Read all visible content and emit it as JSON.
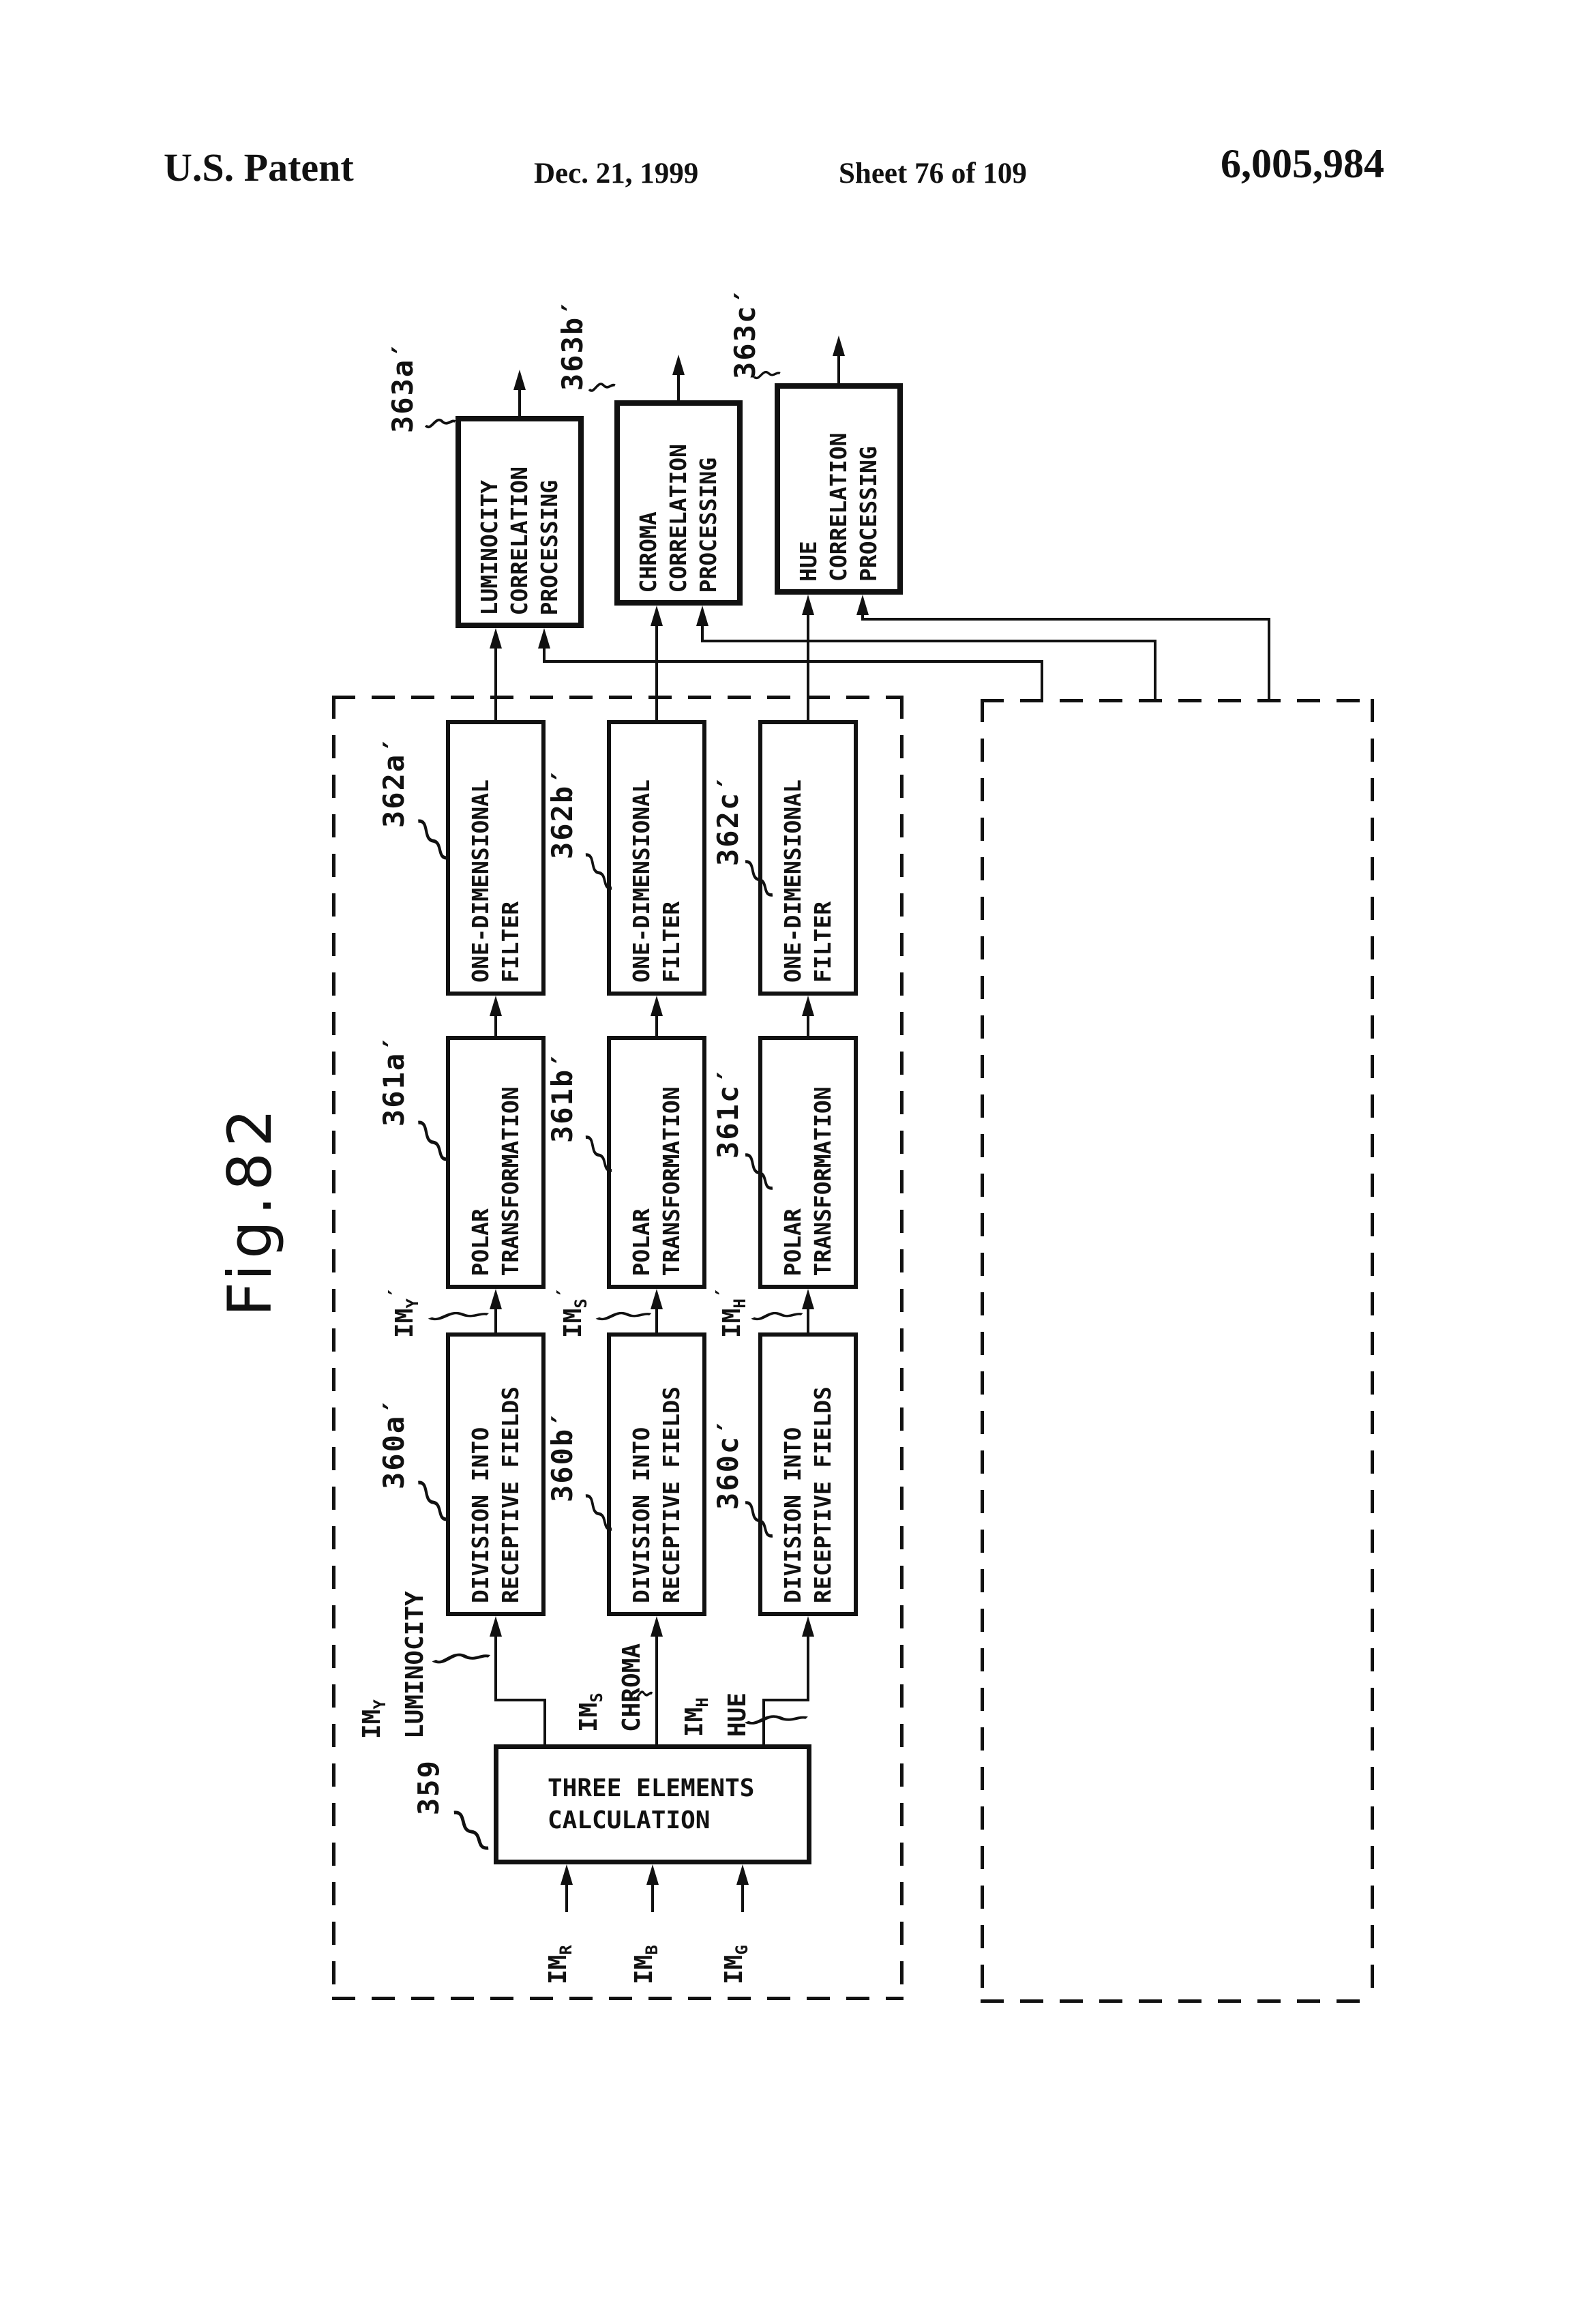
{
  "header": {
    "title": "U.S. Patent",
    "date": "Dec. 21, 1999",
    "sheet": "Sheet 76 of 109",
    "patent_number": "6,005,984"
  },
  "figure": {
    "label": "Fig.82"
  },
  "refs": {
    "r359": "359",
    "r360a": "360a′",
    "r360b": "360b′",
    "r360c": "360c′",
    "r361a": "361a′",
    "r361b": "361b′",
    "r361c": "361c′",
    "r362a": "362a′",
    "r362b": "362b′",
    "r362c": "362c′",
    "r363a": "363a′",
    "r363b": "363b′",
    "r363c": "363c′"
  },
  "blocks": {
    "three_elements": {
      "line1": "THREE ELEMENTS",
      "line2": "CALCULATION"
    },
    "division": {
      "line1": "DIVISION INTO",
      "line2": "RECEPTIVE FIELDS"
    },
    "polar": {
      "line1": "POLAR",
      "line2": "TRANSFORMATION"
    },
    "filter": {
      "line1": "ONE-DIMENSIONAL",
      "line2": "FILTER"
    },
    "corr_luminocity": {
      "line1": "LUMINOCITY",
      "line2": "CORRELATION",
      "line3": "PROCESSING"
    },
    "corr_chroma": {
      "line1": "CHROMA",
      "line2": "CORRELATION",
      "line3": "PROCESSING"
    },
    "corr_hue": {
      "line1": "HUE",
      "line2": "CORRELATION",
      "line3": "PROCESSING"
    }
  },
  "signals": {
    "im_r": {
      "base": "IM",
      "sub": "R"
    },
    "im_b": {
      "base": "IM",
      "sub": "B"
    },
    "im_g": {
      "base": "IM",
      "sub": "G"
    },
    "im_y": {
      "base": "IM",
      "sub": "Y",
      "word": "LUMINOCITY"
    },
    "im_s": {
      "base": "IM",
      "sub": "S",
      "word": "CHROMA"
    },
    "im_h": {
      "base": "IM",
      "sub": "H",
      "word": "HUE"
    },
    "im_y_prime": {
      "base": "IM",
      "sub": "Y",
      "prime": "′"
    },
    "im_s_prime": {
      "base": "IM",
      "sub": "S",
      "prime": "′"
    },
    "im_h_prime": {
      "base": "IM",
      "sub": "H",
      "prime": "′"
    }
  }
}
